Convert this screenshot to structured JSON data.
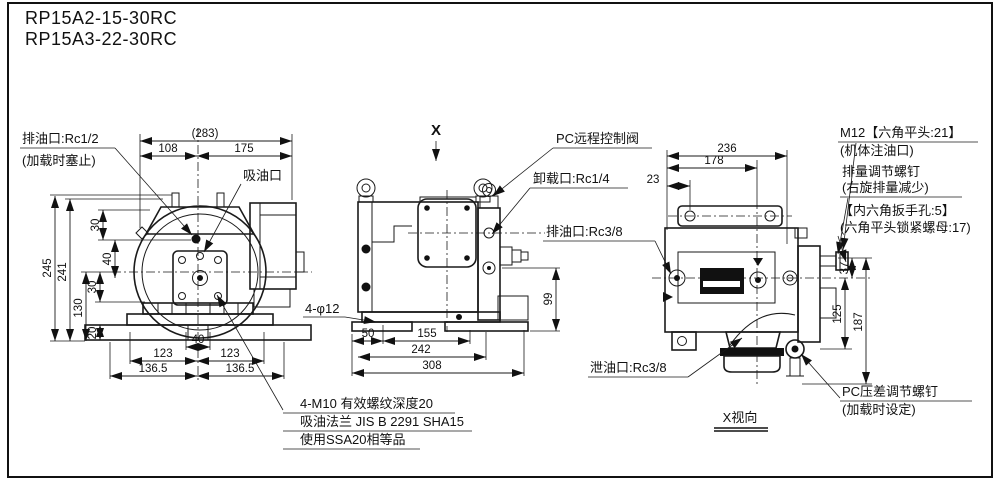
{
  "title": {
    "line1": "RP15A2-15-30RC",
    "line2": "RP15A3-22-30RC"
  },
  "front": {
    "labels": {
      "drain_port": "排油口:Rc1/2",
      "drain_port_note": "(加载时塞止)",
      "suction_port": "吸油口"
    },
    "notes": [
      "4-M10 有效螺纹深度20",
      "吸油法兰 JIS B 2291 SHA15",
      "使用SSA20相等品"
    ],
    "dims": {
      "total": "(283)",
      "w1": "108",
      "w2": "175",
      "h245": "245",
      "h241": "241",
      "h130": "130",
      "s30a": "30",
      "s40": "40",
      "s30b": "30",
      "s20": "20",
      "b40": "40",
      "b123l": "123",
      "b123r": "123",
      "b136l": "136.5",
      "b136r": "136.5"
    }
  },
  "side": {
    "view_marker": "X",
    "labels": {
      "pc_valve": "PC远程控制阀",
      "unload_port": "卸载口:Rc1/4",
      "drain_port": "排油口:Rc3/8",
      "holes": "4-φ12"
    },
    "dims": {
      "d50": "50",
      "d155": "155",
      "d242": "242",
      "d308": "308",
      "d99": "99"
    }
  },
  "xview": {
    "labels": {
      "m12": "M12【六角平头:21】",
      "m12_note": "(机体注油口)",
      "disp_screw": "排量调节螺钉",
      "disp_screw_note": "(右旋排量减少)",
      "hex_hole": "【内六角扳手孔:5】",
      "lock_nut": "(六角平头锁紧螺母:17)",
      "leak_port": "泄油口:Rc3/8",
      "pc_diff_screw": "PC压差调节螺钉",
      "pc_diff_note": "(加载时设定)",
      "view_label": "X视向"
    },
    "dims": {
      "d236": "236",
      "d178": "178",
      "d23": "23",
      "d37": "37",
      "d125": "125",
      "d187": "187"
    }
  }
}
